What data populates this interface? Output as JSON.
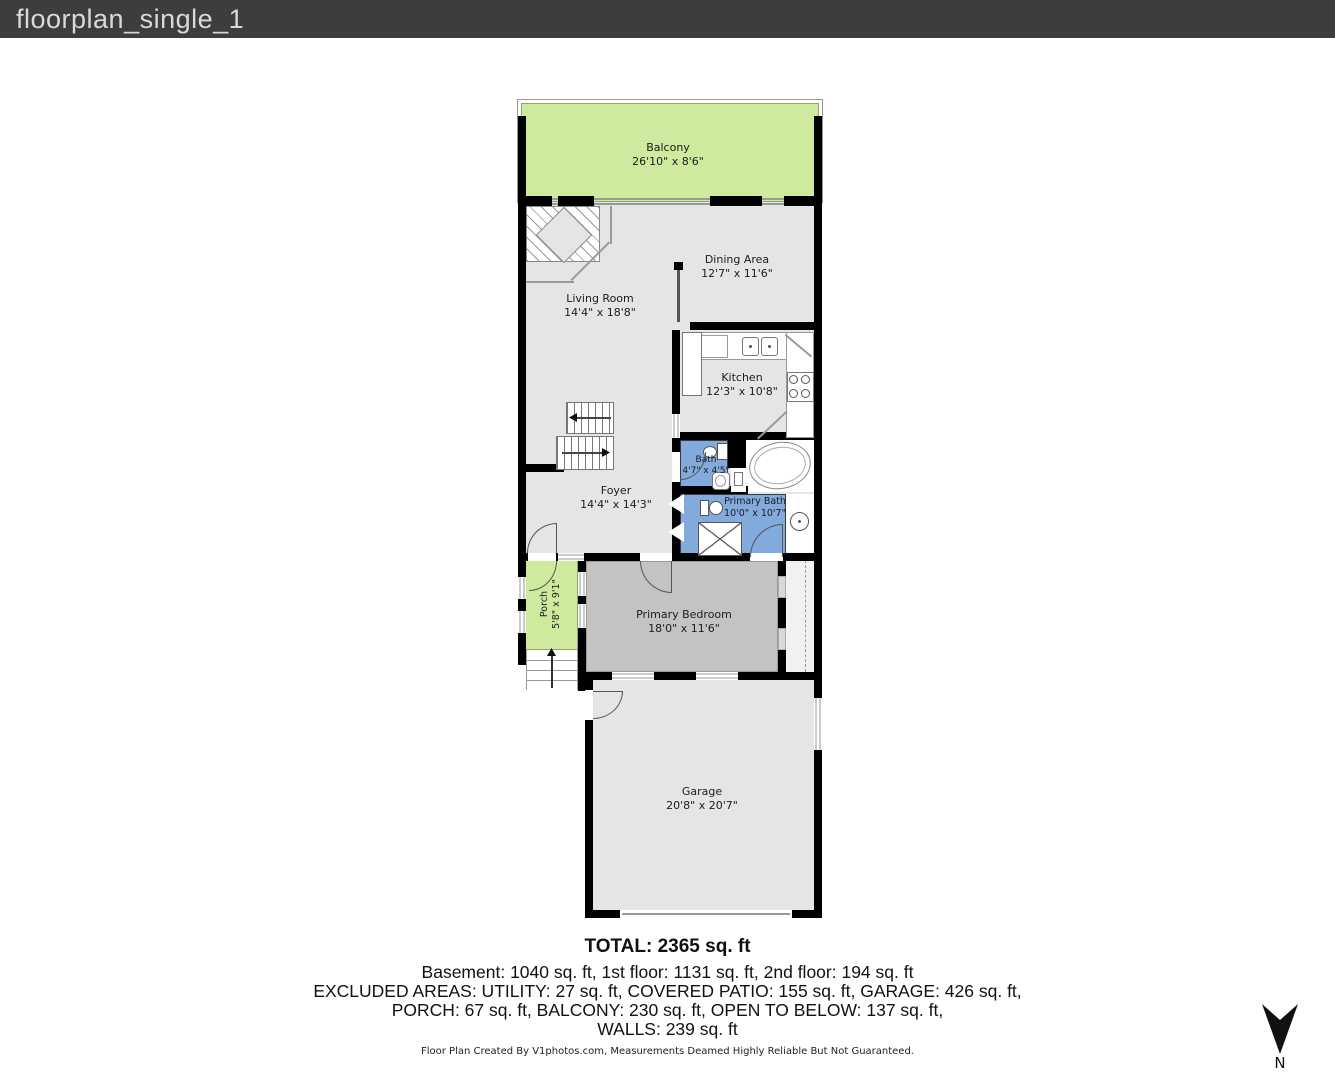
{
  "header": {
    "title": "floorplan_single_1"
  },
  "rooms": {
    "balcony": {
      "name": "Balcony",
      "dims": "26'10\" x 8'6\""
    },
    "living": {
      "name": "Living Room",
      "dims": "14'4\" x 18'8\""
    },
    "dining": {
      "name": "Dining Area",
      "dims": "12'7\" x 11'6\""
    },
    "kitchen": {
      "name": "Kitchen",
      "dims": "12'3\" x 10'8\""
    },
    "bath": {
      "name": "Bath",
      "dims": "4'7\" x 4'5\""
    },
    "primary_bath": {
      "name": "Primary Bath",
      "dims": "10'0\" x 10'7\""
    },
    "foyer": {
      "name": "Foyer",
      "dims": "14'4\" x 14'3\""
    },
    "porch": {
      "name": "Porch",
      "dims": "5'8\" x 9'1\""
    },
    "primary_bedroom": {
      "name": "Primary Bedroom",
      "dims": "18'0\" x 11'6\""
    },
    "garage": {
      "name": "Garage",
      "dims": "20'8\" x 20'7\""
    }
  },
  "summary": {
    "total": "TOTAL: 2365 sq. ft",
    "line1": "Basement: 1040 sq. ft, 1st floor: 1131 sq. ft, 2nd floor: 194 sq. ft",
    "line2": "EXCLUDED AREAS: UTILITY: 27 sq. ft, COVERED PATIO: 155 sq. ft, GARAGE: 426 sq. ft,",
    "line3": "PORCH: 67 sq. ft, BALCONY: 230 sq. ft, OPEN TO BELOW: 137 sq. ft,",
    "line4": "WALLS: 239 sq. ft"
  },
  "footer": {
    "credit": "Floor Plan Created By V1photos.com, Measurements Deamed Highly Reliable But Not Guaranteed."
  },
  "compass": {
    "label": "N"
  },
  "colors": {
    "header_bg": "#3d3d3d",
    "wall": "#000000",
    "floor_gray": "#e5e5e5",
    "bedroom_gray": "#c3c3c3",
    "green": "#cdea9f",
    "blue": "#82aadd",
    "closet_gray": "#f1f1f1"
  }
}
